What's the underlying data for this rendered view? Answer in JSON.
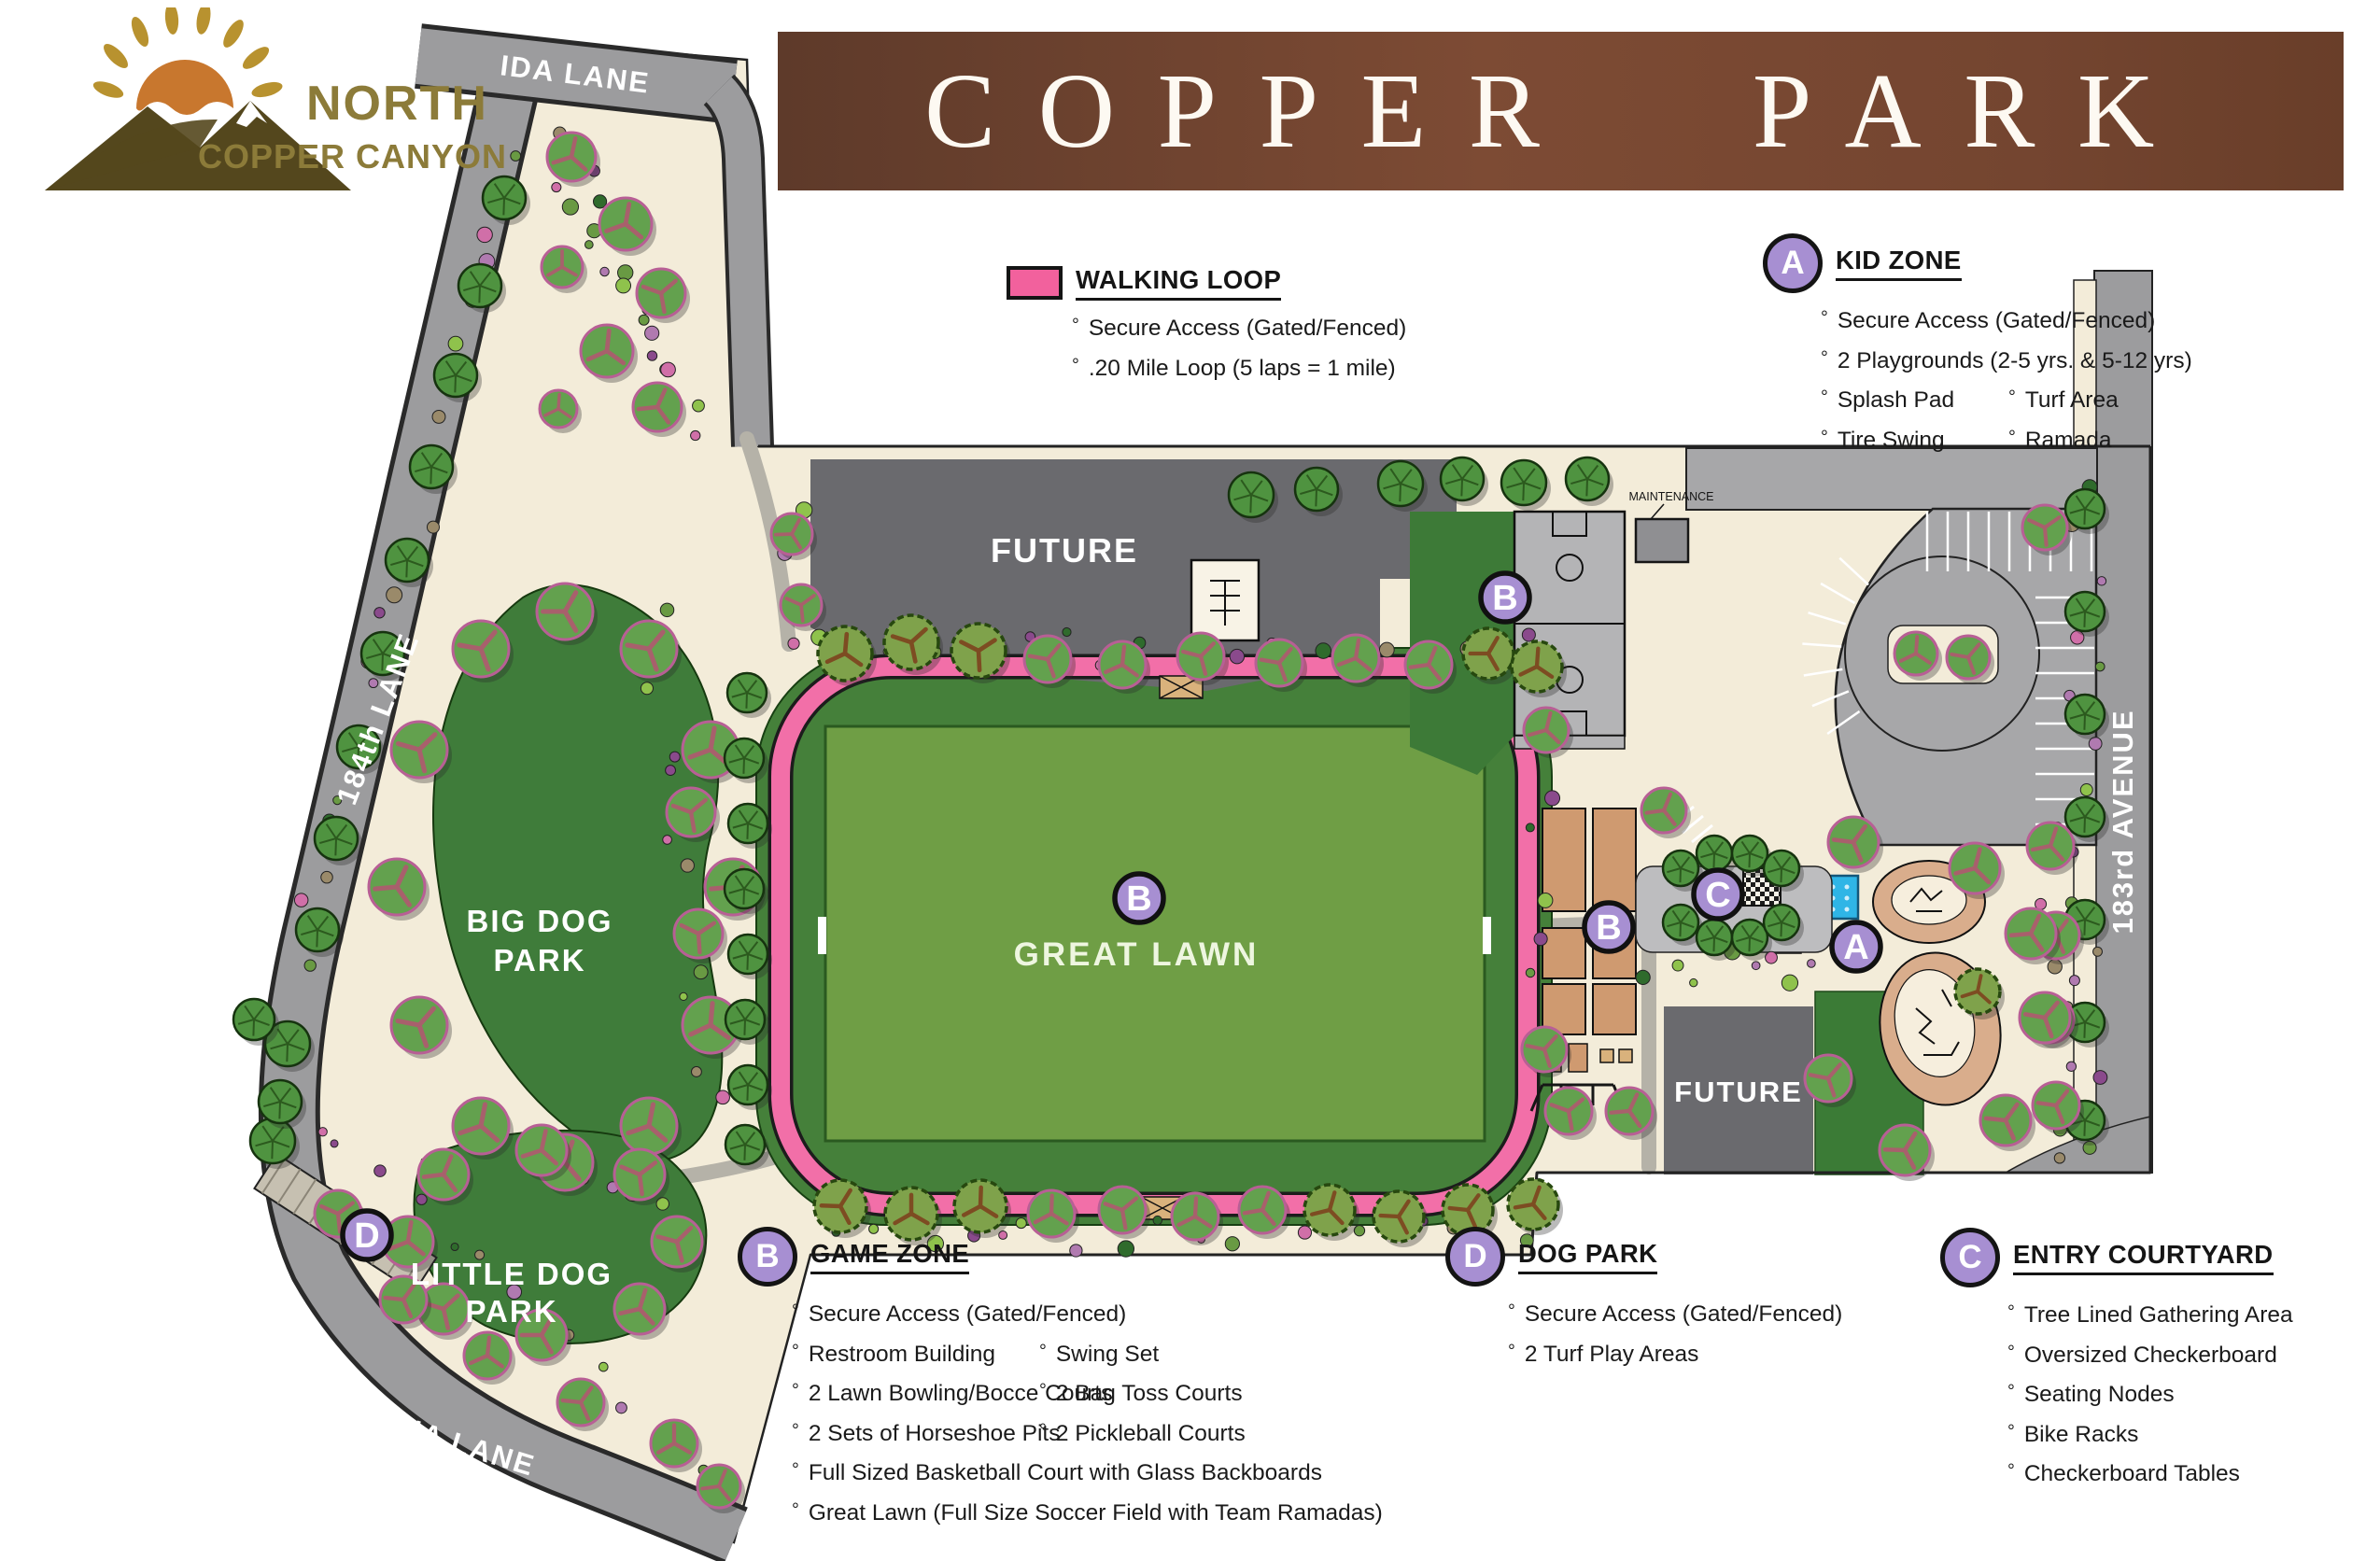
{
  "logo": {
    "title_line1": "NORTH",
    "title_line2": "COPPER CANYON"
  },
  "banner": {
    "title": "COPPER PARK"
  },
  "legend": {
    "walking_loop": {
      "title": "WALKING LOOP",
      "swatch_color": "#f2619d",
      "items": [
        "Secure Access (Gated/Fenced)",
        ".20 Mile Loop (5 laps = 1 mile)"
      ]
    },
    "kid_zone": {
      "marker": "A",
      "title": "KID ZONE",
      "items_full": [
        "Secure Access (Gated/Fenced)",
        "2 Playgrounds (2-5 yrs. & 5-12 yrs)"
      ],
      "items_col1": [
        "Splash Pad",
        "Tire Swing"
      ],
      "items_col2": [
        "Turf Area",
        "Ramada"
      ]
    },
    "game_zone": {
      "marker": "B",
      "title": "GAME ZONE",
      "items_full_top": [
        "Secure Access (Gated/Fenced)"
      ],
      "items_col1": [
        "Restroom Building",
        "2 Lawn Bowling/Bocce Courts",
        "2 Sets of Horseshoe Pits"
      ],
      "items_col2": [
        "Swing Set",
        "2 Bag Toss Courts",
        "2 Pickleball Courts"
      ],
      "items_full_bottom": [
        "Full Sized Basketball Court with Glass Backboards",
        "Great Lawn (Full Size Soccer Field with Team Ramadas)"
      ]
    },
    "dog_park": {
      "marker": "D",
      "title": "DOG PARK",
      "items": [
        "Secure Access (Gated/Fenced)",
        "2 Turf Play Areas"
      ]
    },
    "entry_courtyard": {
      "marker": "C",
      "title": "ENTRY COURTYARD",
      "items": [
        "Tree Lined Gathering Area",
        "Oversized Checkerboard",
        "Seating Nodes",
        "Bike Racks",
        "Checkerboard Tables"
      ]
    }
  },
  "map": {
    "roads": {
      "ida_lane": "IDA LANE",
      "lane_184": "184th LANE",
      "tina_lane": "TINA LANE",
      "avenue_183": "183rd AVENUE"
    },
    "areas": {
      "big_dog_line1": "BIG DOG",
      "big_dog_line2": "PARK",
      "little_dog_line1": "LITTLE DOG",
      "little_dog_line2": "PARK",
      "great_lawn": "GREAT LAWN",
      "future": "FUTURE",
      "maintenance": "MAINTENANCE"
    },
    "markers": {
      "kid_zone": "A",
      "game_zone": "B",
      "entry_courtyard": "C",
      "dog_park": "D"
    },
    "colors": {
      "walking_loop": "#f2619d",
      "marker_fill": "#a78fd2",
      "turf_dark": "#41763b",
      "lawn_light": "#6f9e45",
      "road_gray": "#9c9c9e",
      "future_gray": "#696a6e",
      "ground_cream": "#f3ecd9",
      "splash_blue": "#2fb5e6",
      "court_clay": "#cf9a70",
      "banner_brown": "#7a4a33"
    }
  }
}
